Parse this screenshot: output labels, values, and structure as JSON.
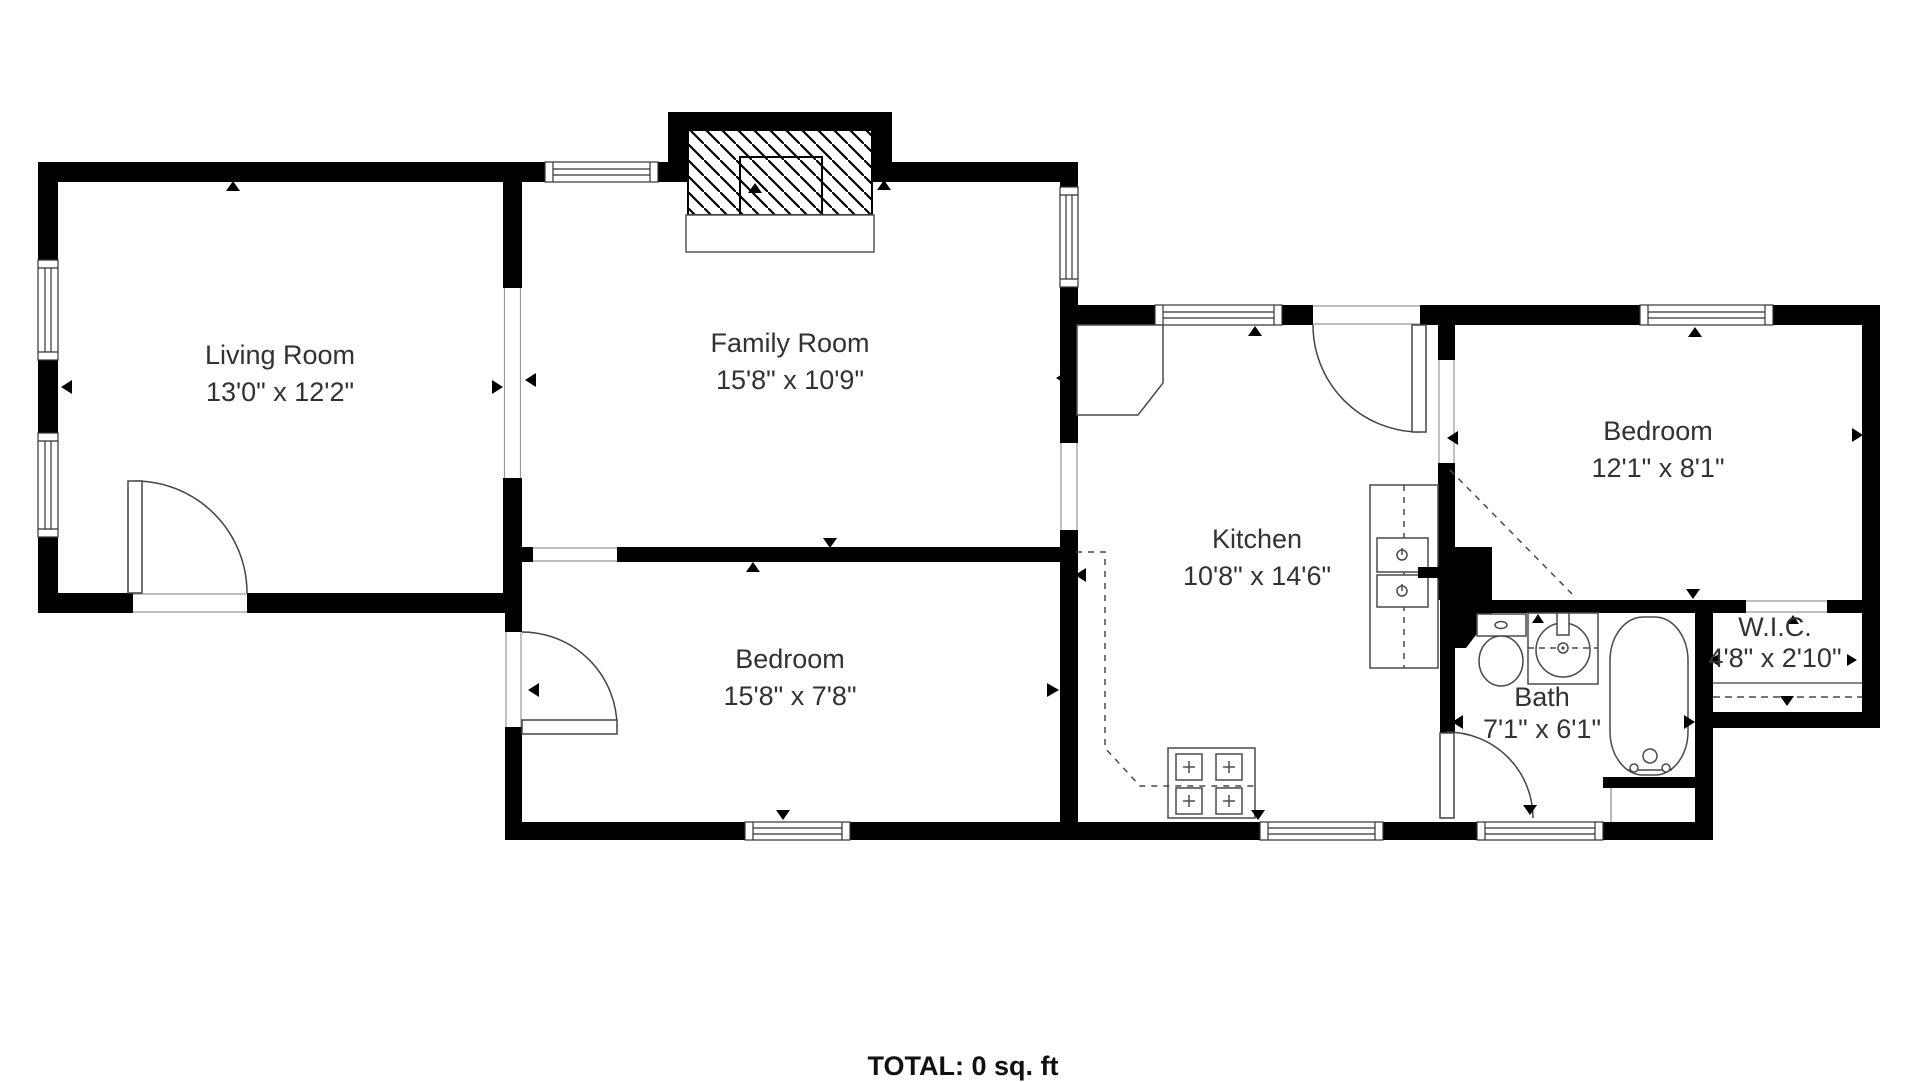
{
  "rooms": [
    {
      "id": "living-room",
      "name": "Living Room",
      "dims": "13'0\" x 12'2\""
    },
    {
      "id": "family-room",
      "name": "Family Room",
      "dims": "15'8\" x 10'9\""
    },
    {
      "id": "kitchen",
      "name": "Kitchen",
      "dims": "10'8\" x 14'6\""
    },
    {
      "id": "bedroom-right",
      "name": "Bedroom",
      "dims": "12'1\" x 8'1\""
    },
    {
      "id": "bedroom-bottom",
      "name": "Bedroom",
      "dims": "15'8\" x 7'8\""
    },
    {
      "id": "bath",
      "name": "Bath",
      "dims": "7'1\" x 6'1\""
    },
    {
      "id": "wic",
      "name": "W.I.C.",
      "dims": "4'8\" x 2'10\""
    }
  ],
  "footer": {
    "total_label": "TOTAL: 0 sq. ft"
  },
  "fixtures": [
    "fireplace",
    "stove",
    "kitchen-sink",
    "corner-pantry",
    "toilet",
    "bathroom-sink",
    "bathtub",
    "closet-shelf"
  ],
  "colors": {
    "wall": "#000000",
    "fixture_line": "#4a4a4a",
    "label_text": "#323232"
  }
}
